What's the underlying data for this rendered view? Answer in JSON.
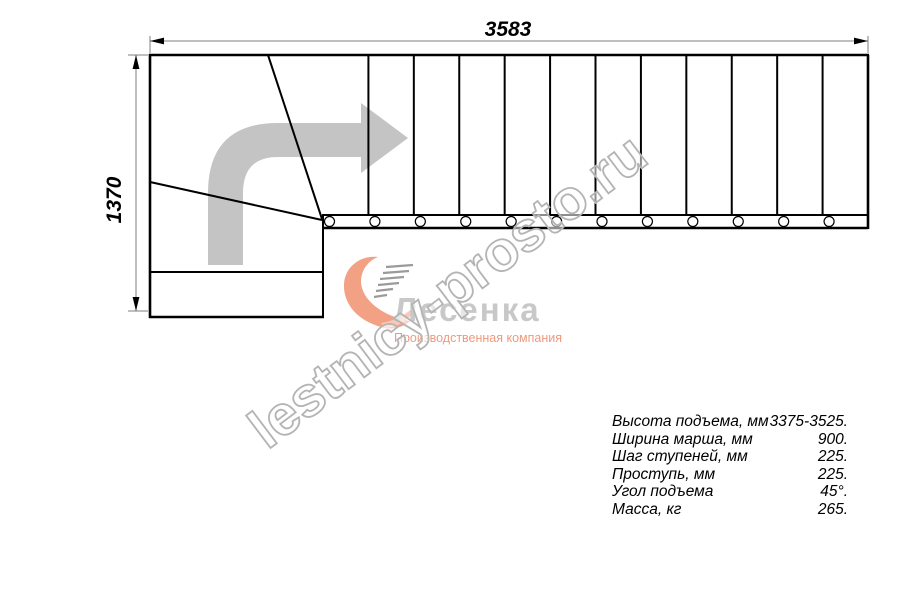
{
  "drawing": {
    "dim_width_label": "3583",
    "dim_height_label": "1370",
    "straight_step_count": 12,
    "step_divider_count": 11,
    "baluster_count": 12,
    "winder_divider_count": 2
  },
  "specs": {
    "rows": [
      {
        "label": "Высота подъема, мм",
        "value": "3375-3525."
      },
      {
        "label": "Ширина марша, мм",
        "value": "900."
      },
      {
        "label": "Шаг ступеней, мм",
        "value": "225."
      },
      {
        "label": "Проступь, мм",
        "value": "225."
      },
      {
        "label": "Угол подъема",
        "value": "45°."
      },
      {
        "label": "Масса, кг",
        "value": "265."
      }
    ]
  },
  "logo": {
    "name": "Лесенка",
    "tagline": "Производственная компания"
  },
  "watermark": {
    "text": "lestnicy-prosto.ru"
  },
  "colors": {
    "line_black": "#000000",
    "dimension_gray": "#7f7f7f",
    "arrow_gray": "#c4c4c4",
    "watermark_gray": "#b4b4b4",
    "logo_salmon": "#f2a185",
    "logo_salmon_light": "#f8c9b6",
    "logo_text_gray": "#c8c8c8",
    "logo_tagline_salmon": "#ee9a7d"
  }
}
